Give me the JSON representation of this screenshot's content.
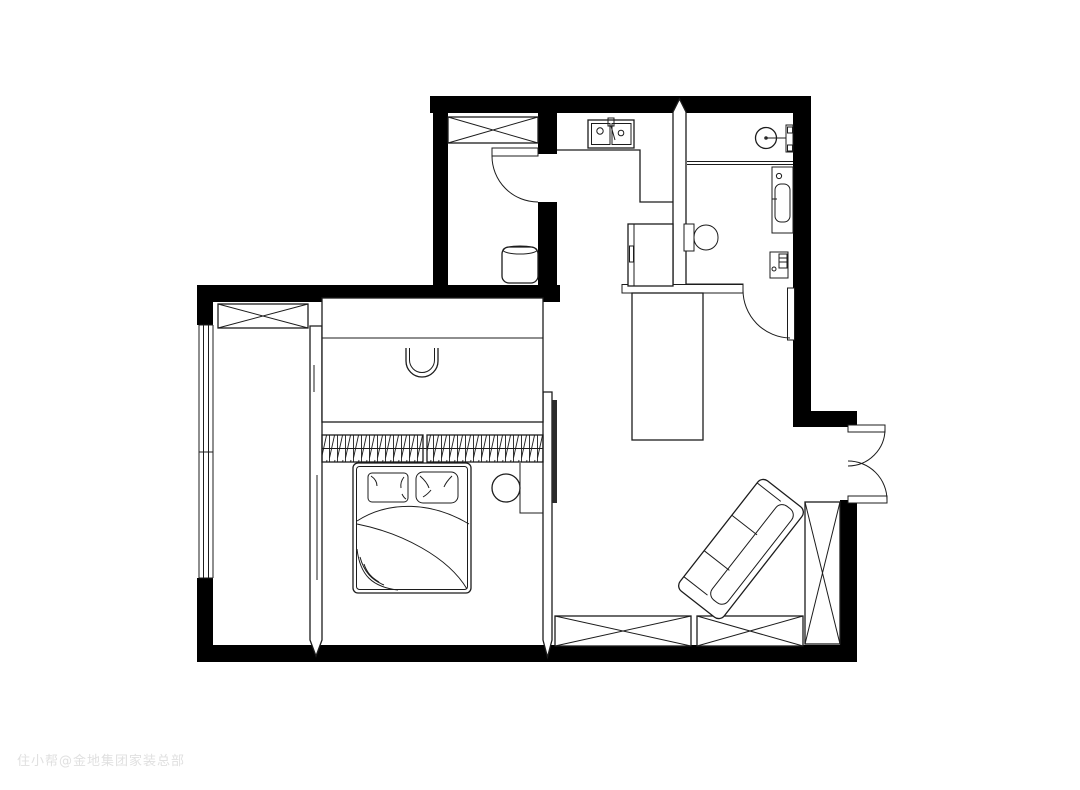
{
  "watermark": {
    "text": "住小帮@金地集团家装总部"
  },
  "plan": {
    "colors": {
      "background": "#ffffff",
      "floor": "#ffffff",
      "wall": "#000000",
      "line": "#1c1c1c",
      "tv": "#2b2b2b",
      "watermark": "#e0e0e0"
    }
  }
}
